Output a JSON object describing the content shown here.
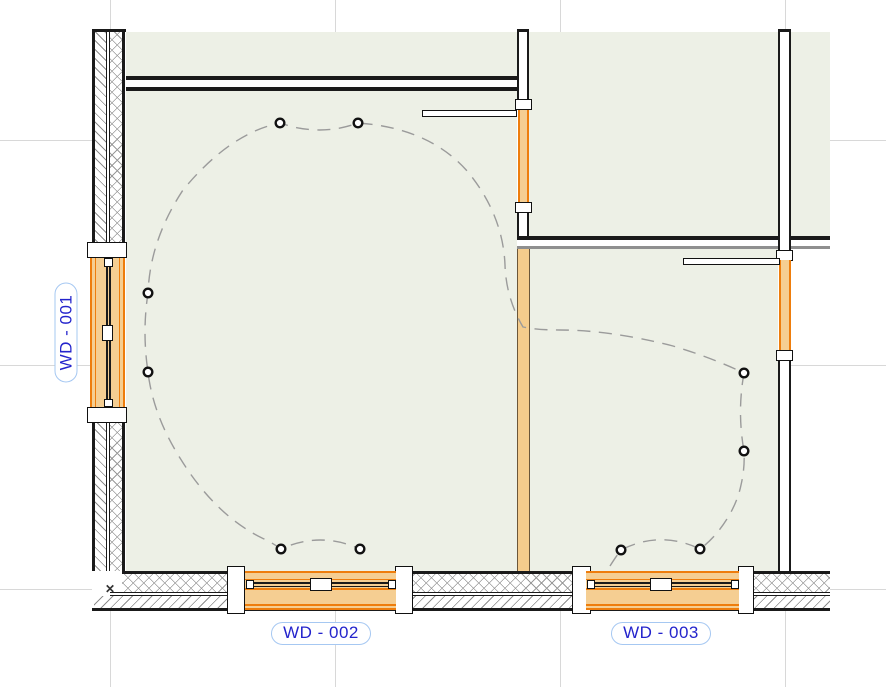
{
  "plan": {
    "view_type": "floor-plan",
    "floor_fill": "#EDF0E6",
    "outside_fill": "#FFFFFF",
    "grid_color": "#D8D8D8"
  },
  "tags": {
    "wd001": "WD - 001",
    "wd002": "WD - 002",
    "wd003": "WD - 003"
  },
  "palette": {
    "window_panel": "#F5CE92",
    "window_accent": "#EE7D0C",
    "wood_wall_fill": "#F5CC8C",
    "wall_line": "#1A1A1A",
    "wire_line": "#9B9B9B",
    "tag_text": "#2424CC",
    "tag_border": "#A6C8F2"
  },
  "fixtures": {
    "count": 10,
    "symbol": "small-circle"
  }
}
